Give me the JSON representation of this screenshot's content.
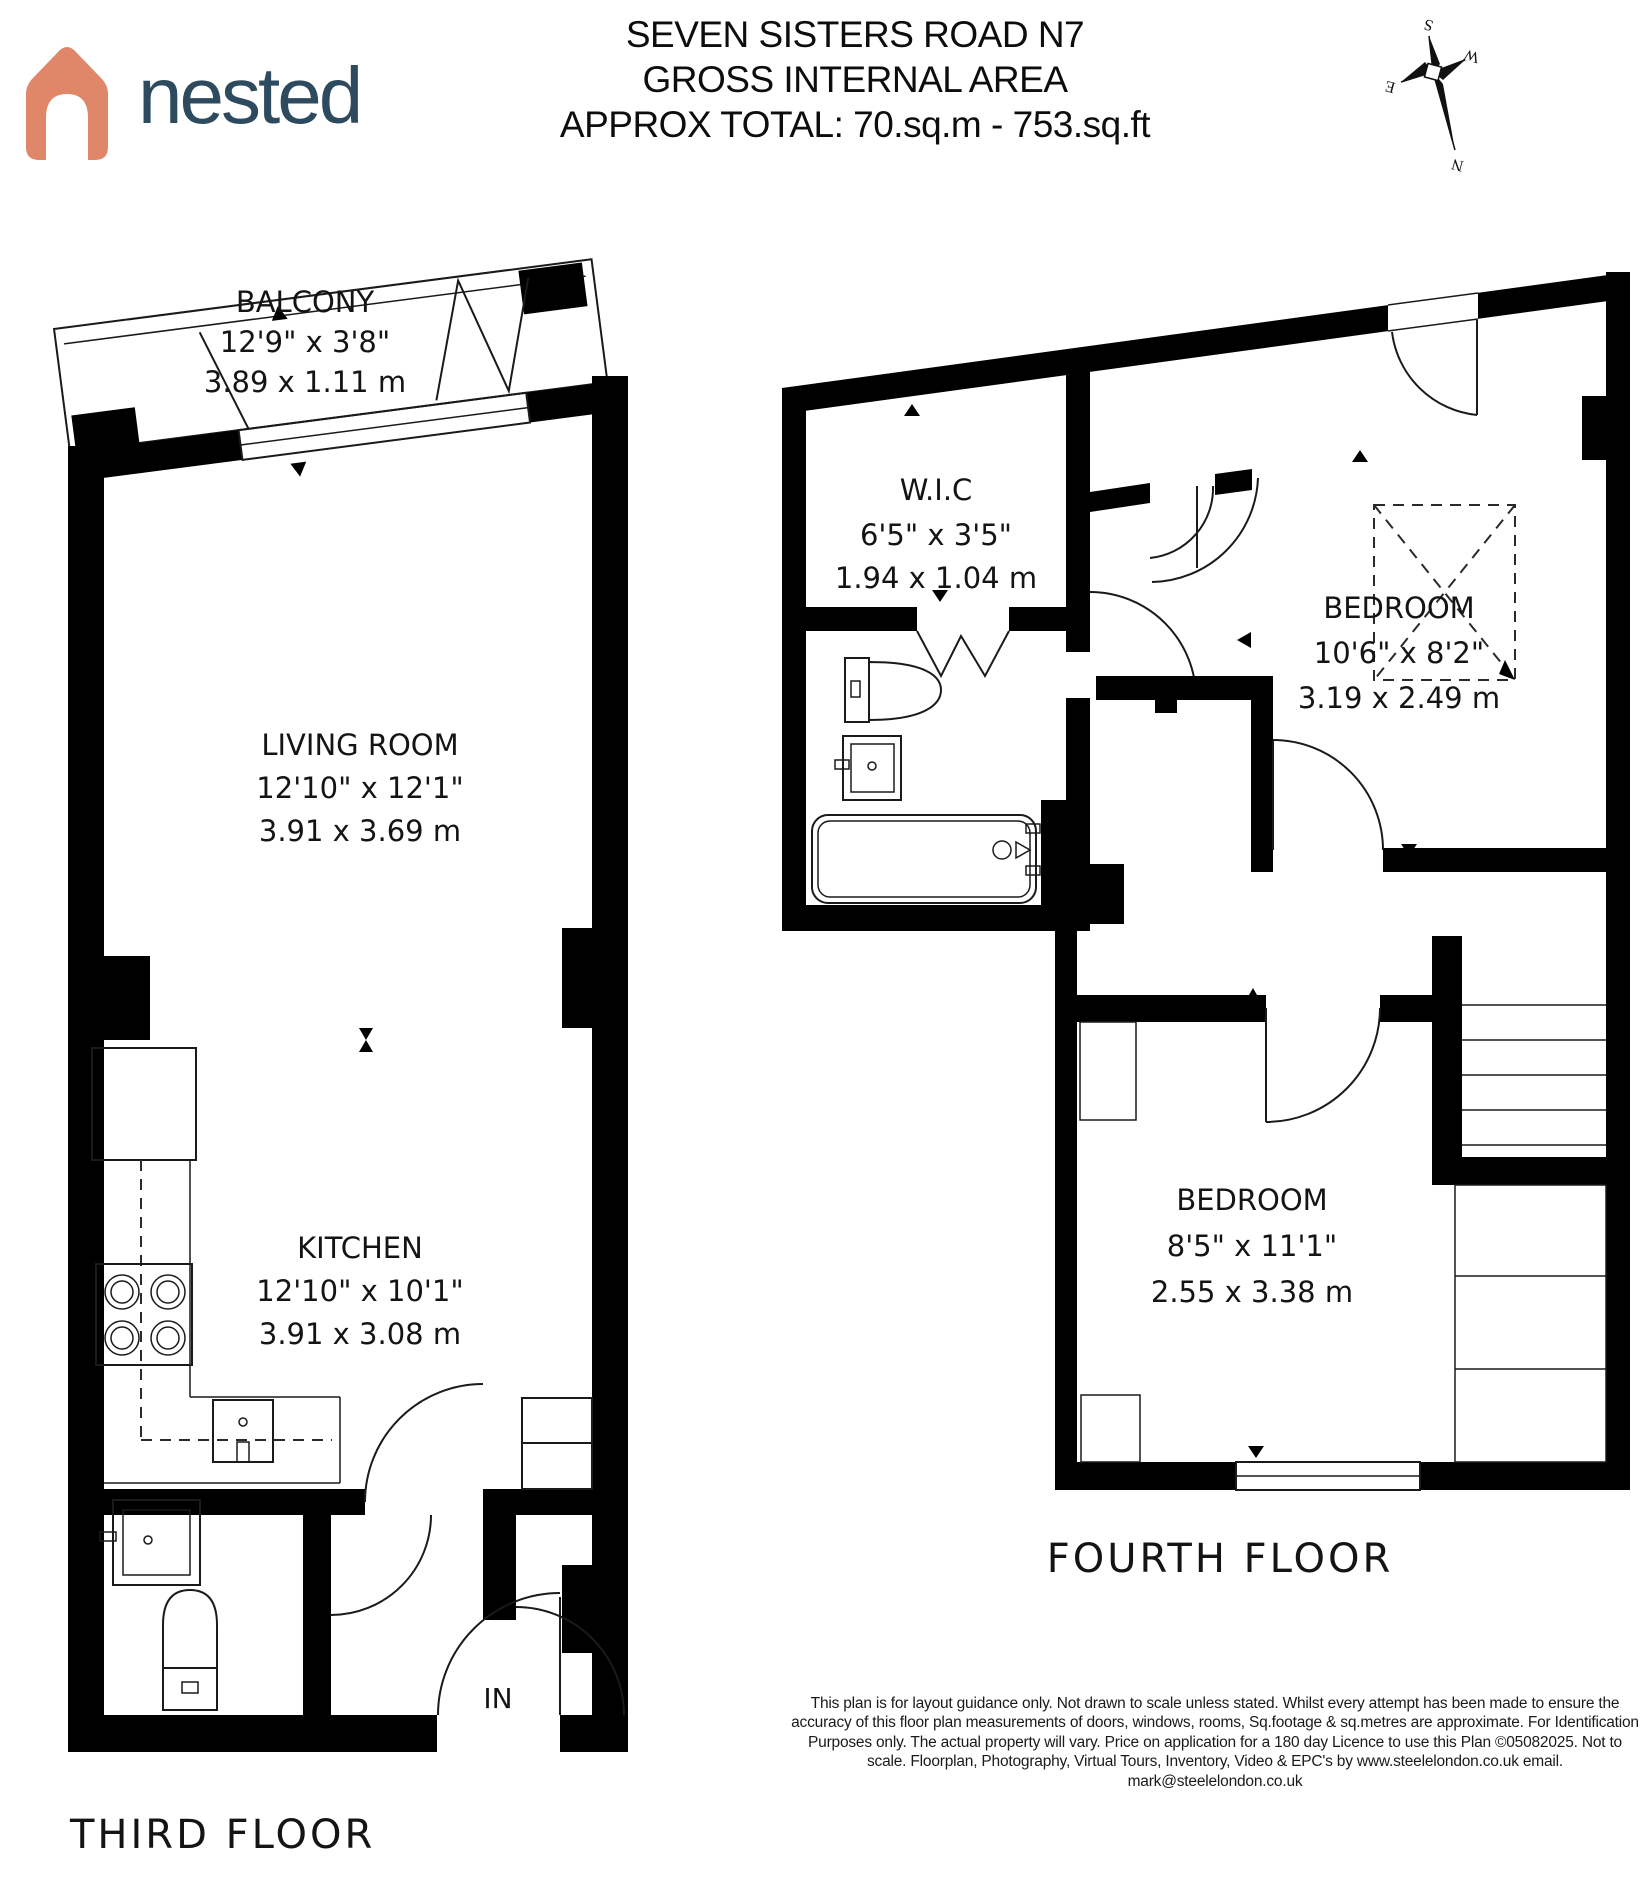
{
  "header": {
    "brand": "nested",
    "title_line1": "SEVEN SISTERS ROAD N7",
    "title_line2": "GROSS INTERNAL AREA",
    "title_line3": "APPROX TOTAL: 70.sq.m - 753.sq.ft"
  },
  "compass": {
    "n": "N",
    "s": "S",
    "e": "E",
    "w": "W"
  },
  "third_floor": {
    "label": "THIRD FLOOR",
    "in_label": "IN",
    "balcony": {
      "name": "BALCONY",
      "imperial": "12'9\" x 3'8\"",
      "metric": "3.89 x 1.11 m"
    },
    "living_room": {
      "name": "LIVING ROOM",
      "imperial": "12'10\" x 12'1\"",
      "metric": "3.91 x 3.69 m"
    },
    "kitchen": {
      "name": "KITCHEN",
      "imperial": "12'10\" x 10'1\"",
      "metric": "3.91 x 3.08 m"
    }
  },
  "fourth_floor": {
    "label": "FOURTH FLOOR",
    "wic": {
      "name": "W.I.C",
      "imperial": "6'5\" x 3'5\"",
      "metric": "1.94 x 1.04 m"
    },
    "bedroom_top": {
      "name": "BEDROOM",
      "imperial": "10'6\" x 8'2\"",
      "metric": "3.19 x 2.49 m"
    },
    "bedroom_bottom": {
      "name": "BEDROOM",
      "imperial": "8'5\" x 11'1\"",
      "metric": "2.55 x 3.38 m"
    }
  },
  "disclaimer": "This plan is for layout guidance only. Not drawn to scale unless stated. Whilst every attempt has been made to ensure the accuracy of this floor plan measurements of doors, windows, rooms, Sq.footage & sq.metres are approximate. For Identification Purposes only. The actual property will vary. Price on application for a 180 day Licence to use this Plan ©05082025. Not to scale. Floorplan, Photography, Virtual Tours, Inventory, Video & EPC's by www.steelelondon.co.uk  email. mark@steelelondon.co.uk",
  "colors": {
    "brand_orange": "#E0876A",
    "brand_navy": "#2D4A5E",
    "wall": "#000000"
  }
}
